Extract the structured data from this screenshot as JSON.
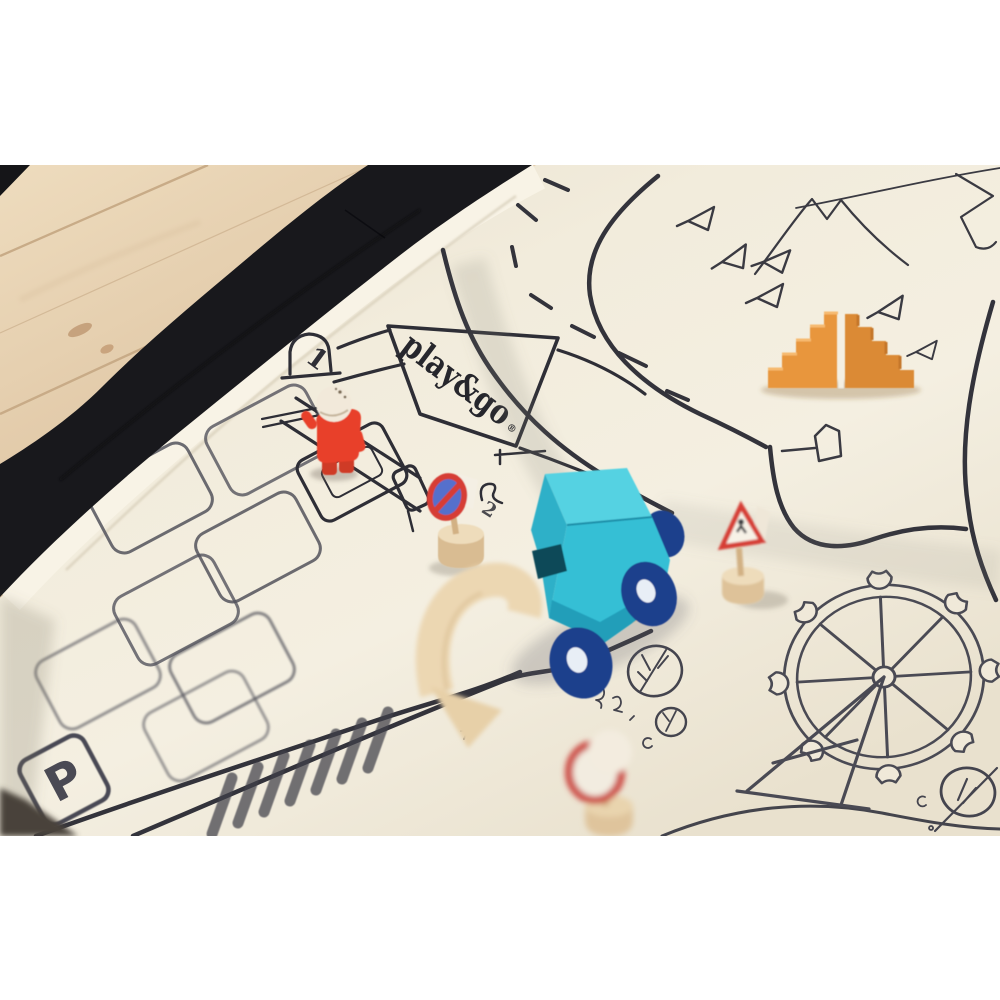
{
  "image_type": "photograph",
  "scene": {
    "description": "play&go toy storage bag opened flat as a play mat printed with a black-line city road map, lying on a light wooden floor, with wooden toys placed on it",
    "floor": "light oak wooden floorboards, diagonal",
    "mat": "cream canvas mat with black city illustration and black fabric rim of the storage bag"
  },
  "logo": {
    "text": "play&go",
    "registered_mark": "®"
  },
  "map_labels": {
    "parking_sign": "P",
    "shop_door_number": "1",
    "counter_squiggle": "2"
  },
  "illustration_features": [
    "winding road with dashed center line",
    "parking lot with rounded parking bays and P sign",
    "shop building with play&go signboard and numbered door",
    "zebra crosswalk",
    "mountain peaks and ridge line",
    "pine trees drawn as small triangles",
    "ferris wheel with eight gondolas and A-frame legs",
    "round park trees with branches",
    "small bus-stop style sign connected to the road"
  ],
  "toys": [
    {
      "name": "wooden truck",
      "color": "turquoise cab, navy blue wheels, natural wood bed"
    },
    {
      "name": "toy figure",
      "color": "red body with natural wood head"
    },
    {
      "name": "stair blocks",
      "color": "orange, two mirrored staircase halves"
    },
    {
      "name": "wooden arch",
      "color": "natural wood, blurred foreground"
    },
    {
      "name": "no-parking sign",
      "color": "red ring, blue centre, wooden post and base"
    },
    {
      "name": "warning triangle sign",
      "color": "white with red border on wooden post"
    },
    {
      "name": "round sign with ball",
      "color": "white disc with red ring, blurred foreground"
    }
  ],
  "colors": {
    "bag_black": "#18181c",
    "mat_cream": "#f0e9d9",
    "ink": "#33333b",
    "floor_wood": "#dcc3a2",
    "truck_teal": "#36bfd5",
    "truck_teal_light": "#55d2e2",
    "truck_teal_dark": "#2fb0c8",
    "wheel_navy": "#1f3f8c",
    "figure_red": "#e8402a",
    "stairs_orange": "#e8963e",
    "stairs_orange_dark": "#db8a35",
    "sign_red": "#d63c34",
    "sign_blue": "#5570cc",
    "wood_toy": "#e6cfa9"
  }
}
